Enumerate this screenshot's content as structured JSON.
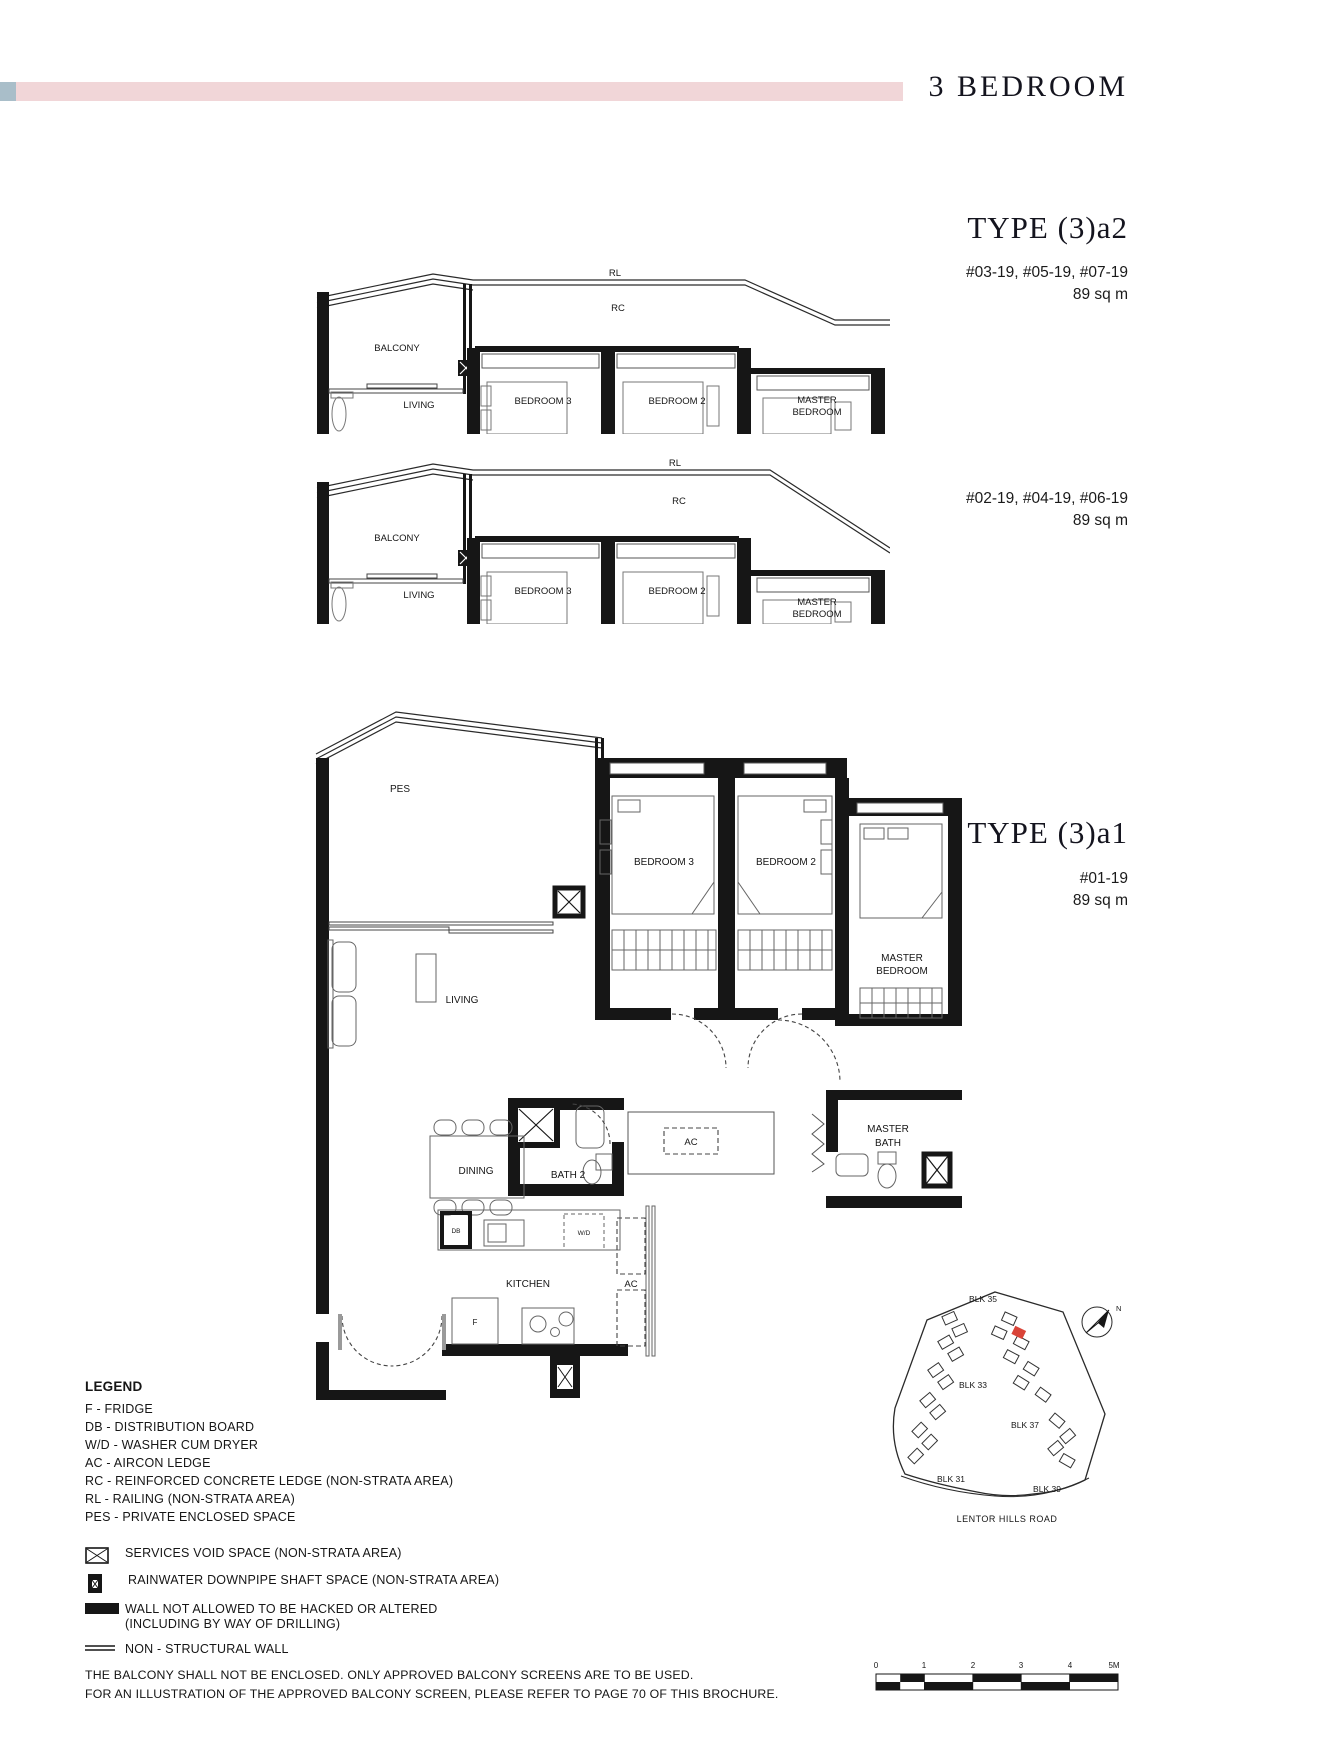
{
  "page": {
    "title": "3 BEDROOM",
    "accent_pink": "#f1d6d8",
    "accent_blue": "#a9bec9"
  },
  "type_a2": {
    "heading": "TYPE (3)a2",
    "stack1_units": "#03-19, #05-19, #07-19",
    "stack1_area": "89 sq m",
    "stack2_units": "#02-19, #04-19, #06-19",
    "stack2_area": "89 sq m"
  },
  "type_a1": {
    "heading": "TYPE (3)a1",
    "units": "#01-19",
    "area": "89 sq m"
  },
  "section_labels": {
    "rl": "RL",
    "rc": "RC",
    "balcony": "BALCONY",
    "living": "LIVING",
    "bedroom3": "BEDROOM 3",
    "bedroom2": "BEDROOM 2",
    "master1": "MASTER",
    "master2": "BEDROOM"
  },
  "plan_labels": {
    "pes": "PES",
    "living": "LIVING",
    "bedroom3": "BEDROOM 3",
    "bedroom2": "BEDROOM 2",
    "master1": "MASTER",
    "master2": "BEDROOM",
    "dining": "DINING",
    "bath2": "BATH 2",
    "masterbath1": "MASTER",
    "masterbath2": "BATH",
    "kitchen": "KITCHEN",
    "ac": "AC",
    "db": "DB",
    "wd": "W/D",
    "f": "F"
  },
  "legend": {
    "title": "LEGEND",
    "items": [
      "F - FRIDGE",
      "DB - DISTRIBUTION BOARD",
      "W/D - WASHER CUM DRYER",
      "AC - AIRCON LEDGE",
      "RC - REINFORCED CONCRETE LEDGE (NON-STRATA AREA)",
      "RL - RAILING (NON-STRATA AREA)",
      "PES - PRIVATE ENCLOSED SPACE"
    ],
    "sym1": "SERVICES VOID SPACE (NON-STRATA AREA)",
    "sym2": "RAINWATER DOWNPIPE SHAFT SPACE (NON-STRATA AREA)",
    "sym3a": "WALL NOT ALLOWED TO BE HACKED OR ALTERED",
    "sym3b": "(INCLUDING BY WAY OF DRILLING)",
    "sym4": "NON - STRUCTURAL WALL"
  },
  "site_plan": {
    "blocks": [
      "BLK 35",
      "BLK 33",
      "BLK 37",
      "BLK 31",
      "BLK 39"
    ],
    "road": "LENTOR HILLS ROAD",
    "north": "N",
    "highlight_color": "#d94438"
  },
  "scale_bar": {
    "ticks": [
      "0",
      "1",
      "2",
      "3",
      "4",
      "5M"
    ]
  },
  "disclaimer": {
    "line1": "THE BALCONY SHALL NOT BE ENCLOSED. ONLY APPROVED BALCONY SCREENS ARE TO BE USED.",
    "line2": "FOR AN ILLUSTRATION OF THE APPROVED BALCONY SCREEN, PLEASE REFER TO PAGE 70 OF THIS BROCHURE."
  }
}
